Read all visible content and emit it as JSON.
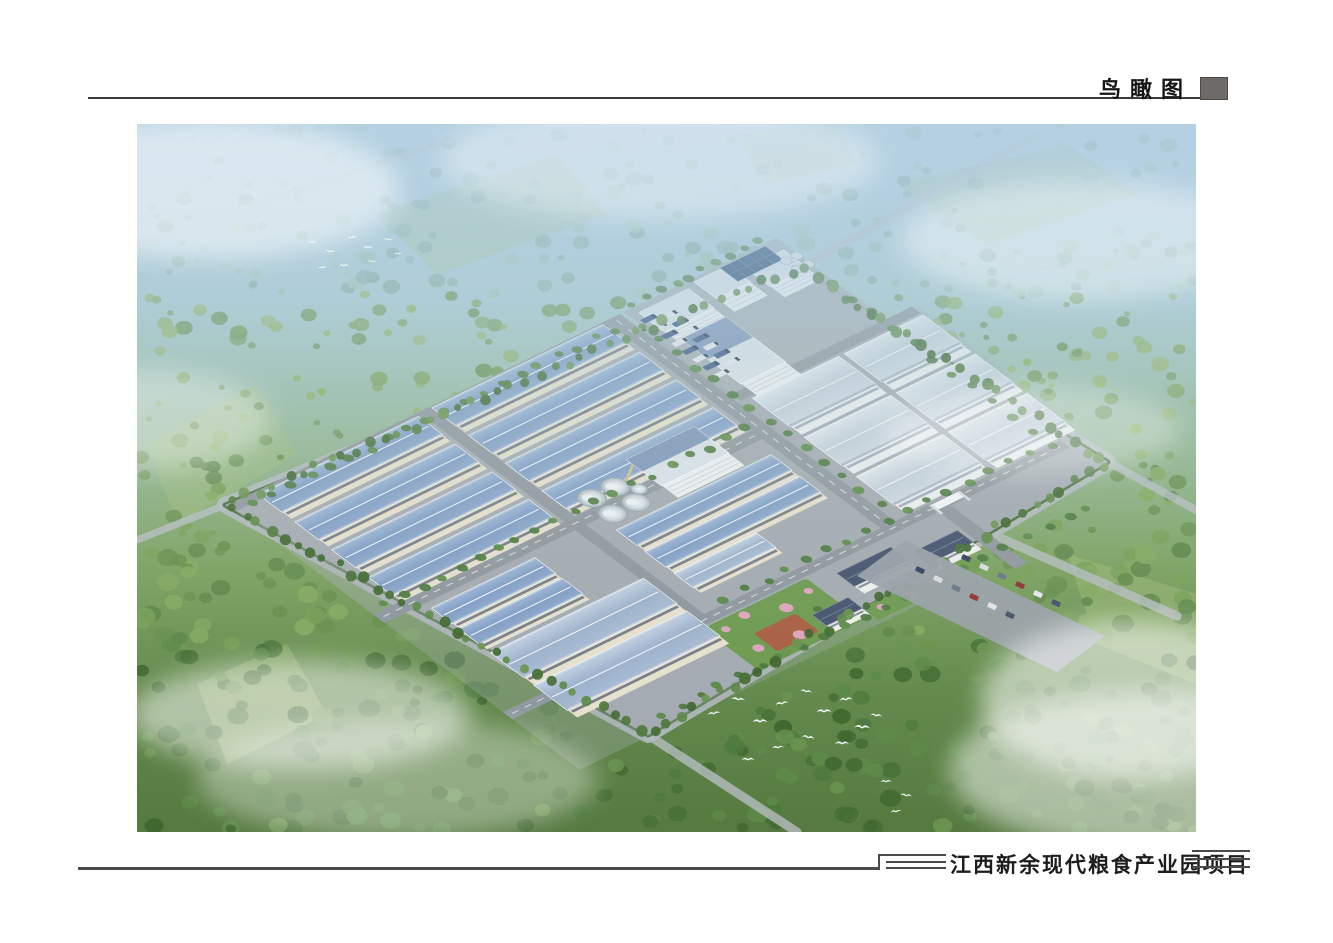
{
  "page": {
    "header": {
      "title": "鸟瞰图",
      "marker_icon": "title-block-square"
    },
    "footer": {
      "project_title": "江西新余现代粮食产业园项目",
      "deco_left_icon": "triple-rule-step",
      "deco_right_icon": "triple-rule"
    }
  },
  "palette": {
    "rule": "#3c3c3c",
    "marker": "#6e6a68",
    "plot": "#a3aab1",
    "road": "#90989f",
    "dash": "#eef1f4",
    "apron": "#a9afb6",
    "ring": "#b4bac0",
    "hedge": "#4a6e3c",
    "blue_roof": [
      "#9fb8d8",
      "#7f9cc6",
      "#8ea9cc"
    ],
    "bluelight_roof": [
      "#c3d2e4",
      "#9db2cd",
      "#aabdd5"
    ],
    "white_roof": [
      "#e2e9f0",
      "#c6d1dd",
      "#d3dce6"
    ],
    "wall_cream": "#e6e0cf",
    "band_dark": "#49566a",
    "wall_white": "#edeff1",
    "band_gray": "#8494a6",
    "tower_wall": "#eff1f4",
    "tower_roof": "#dde3e9",
    "mill_blue": "#7089b2",
    "office_roof": "#47556f",
    "office_wall": "#eef0ee",
    "solar": "#2f4e74",
    "solar_grid": "#52749c",
    "truck_a": "#3c5a88",
    "truck_b": "#e8ebee",
    "silo_stroke": "#97a2ac",
    "conveyor": "#cfc08a",
    "garden": "#6f9b52",
    "garden_tree": "#4e7a3e",
    "blossom": "#e2a6c2",
    "plaza": "#b05a42",
    "bird": "#fbfdfe",
    "bg_stops": [
      [
        0,
        "#b9d3e2"
      ],
      [
        0.25,
        "#a8c9cf"
      ],
      [
        0.45,
        "#93b694"
      ],
      [
        0.62,
        "#7da263"
      ],
      [
        0.8,
        "#648a4e"
      ],
      [
        1,
        "#55793f"
      ]
    ],
    "haze_stops": [
      [
        0,
        "rgba(180,208,226,0.85)"
      ],
      [
        0.18,
        "rgba(180,208,226,0.55)"
      ],
      [
        0.38,
        "rgba(186,212,214,0.28)"
      ],
      [
        0.6,
        "rgba(200,220,205,0.08)"
      ],
      [
        0.78,
        "rgba(200,220,205,0)"
      ]
    ],
    "field": "#a4bf7d",
    "tree_bands": [
      [
        170,
        [
          "#8fb3a4",
          "#9cc0ae",
          "#86ab9d",
          "#a5c6b4"
        ]
      ],
      [
        330,
        [
          "#7ea45f",
          "#8db264",
          "#729a57",
          "#97b46c",
          "#6b9253"
        ]
      ],
      [
        520,
        [
          "#688f4e",
          "#78a058",
          "#5f874a",
          "#83a961"
        ]
      ],
      [
        9999,
        [
          "#4e7a3e",
          "#5d8a49",
          "#456f36",
          "#6b9450",
          "#3f672f"
        ]
      ]
    ],
    "car_colors": [
      "#35435e",
      "#d8dce1",
      "#6b7688",
      "#913535",
      "#e4e6ea",
      "#46536a"
    ]
  },
  "scene": {
    "viewbox": [
      1059,
      708
    ],
    "skew": {
      "a": 0.899,
      "b": -0.438,
      "c": 0.799,
      "d": 0.602,
      "tx": 91,
      "ty": 381
    },
    "plot_polygon": [
      [
        88,
        381
      ],
      [
        660,
        144
      ],
      [
        971,
        338
      ],
      [
        511,
        611
      ]
    ],
    "fields": [
      [
        [
          10,
          320
        ],
        [
          120,
          260
        ],
        [
          160,
          330
        ],
        [
          40,
          400
        ]
      ],
      [
        [
          240,
          90
        ],
        [
          420,
          30
        ],
        [
          470,
          90
        ],
        [
          300,
          150
        ]
      ],
      [
        [
          760,
          60
        ],
        [
          930,
          20
        ],
        [
          1000,
          70
        ],
        [
          850,
          120
        ]
      ],
      [
        [
          930,
          430
        ],
        [
          1059,
          470
        ],
        [
          1059,
          560
        ],
        [
          960,
          520
        ]
      ],
      [
        [
          60,
          560
        ],
        [
          150,
          520
        ],
        [
          190,
          590
        ],
        [
          90,
          640
        ]
      ],
      [
        [
          600,
          10
        ],
        [
          700,
          0
        ],
        [
          720,
          40
        ],
        [
          630,
          60
        ]
      ]
    ],
    "outer_roads": [
      [
        [
          660,
          146
        ],
        [
          900,
          10
        ],
        8
      ],
      [
        [
          511,
          611
        ],
        [
          660,
          708
        ],
        9
      ],
      [
        [
          971,
          338
        ],
        [
          1059,
          386
        ],
        8
      ],
      [
        [
          88,
          381
        ],
        [
          0,
          416
        ],
        7
      ],
      [
        [
          802,
          387
        ],
        [
          1040,
          492
        ],
        9
      ],
      [
        [
          0,
          120
        ],
        [
          330,
          10
        ],
        5
      ]
    ],
    "aprons": [
      [
        0,
        0,
        436,
        182,
        0.4
      ],
      [
        440,
        0,
        170,
        135,
        0.9
      ],
      [
        440,
        140,
        205,
        216,
        0.35
      ],
      [
        0,
        196,
        420,
        244,
        0.3
      ]
    ],
    "roads_local": [
      [
        0,
        0,
        436,
        10,
        0
      ],
      [
        212,
        0,
        12,
        356,
        0
      ],
      [
        0,
        182,
        436,
        14,
        1
      ],
      [
        420,
        0,
        16,
        356,
        1
      ],
      [
        440,
        136,
        200,
        11,
        0
      ],
      [
        0,
        344,
        620,
        12,
        1
      ],
      [
        474,
        356,
        14,
        95,
        0
      ]
    ],
    "structures": [
      [
        225,
        2,
        190,
        30,
        11,
        "blue"
      ],
      [
        225,
        48,
        190,
        30,
        11,
        "blue"
      ],
      [
        225,
        94,
        190,
        30,
        11,
        "blue"
      ],
      [
        225,
        140,
        190,
        30,
        11,
        "blue"
      ],
      [
        30,
        4,
        178,
        30,
        11,
        "blue"
      ],
      [
        30,
        50,
        178,
        30,
        11,
        "blue"
      ],
      [
        30,
        96,
        178,
        30,
        11,
        "blue"
      ],
      [
        30,
        142,
        178,
        30,
        11,
        "blue"
      ],
      [
        45,
        204,
        115,
        26,
        9,
        "blue"
      ],
      [
        45,
        238,
        115,
        26,
        9,
        "blue"
      ],
      [
        45,
        278,
        170,
        42,
        12,
        "bluelight"
      ],
      [
        45,
        332,
        170,
        42,
        12,
        "bluelight"
      ],
      [
        240,
        216,
        172,
        26,
        10,
        "blue"
      ],
      [
        240,
        252,
        172,
        26,
        10,
        "blue"
      ],
      [
        240,
        288,
        92,
        24,
        9,
        "bluelight"
      ],
      [
        450,
        150,
        96,
        48,
        13,
        "white"
      ],
      [
        552,
        150,
        88,
        48,
        13,
        "white"
      ],
      [
        450,
        215,
        96,
        48,
        13,
        "white"
      ],
      [
        552,
        215,
        88,
        48,
        13,
        "white"
      ],
      [
        450,
        280,
        96,
        48,
        13,
        "white"
      ],
      [
        552,
        280,
        88,
        48,
        13,
        "white"
      ],
      [
        450,
        8,
        55,
        32,
        18,
        "tower"
      ],
      [
        515,
        4,
        38,
        28,
        22,
        "tower"
      ],
      [
        562,
        16,
        42,
        30,
        18,
        "tower"
      ],
      [
        455,
        55,
        50,
        75,
        20,
        "mill"
      ],
      [
        310,
        150,
        75,
        44,
        20,
        "mill"
      ],
      [
        350,
        368,
        60,
        22,
        12,
        "office"
      ],
      [
        420,
        384,
        50,
        20,
        11,
        "office"
      ],
      [
        296,
        398,
        40,
        18,
        10,
        "office"
      ],
      [
        475,
        345,
        30,
        9,
        8,
        "gate"
      ]
    ],
    "solar": [
      545,
      3,
      50,
      22
    ],
    "silos": {
      "big": [
        [
          252,
          172
        ],
        [
          278,
          172
        ],
        [
          252,
          198
        ],
        [
          278,
          198
        ]
      ],
      "bigR": 12,
      "extra": [
        292,
        186,
        7
      ],
      "small": [
        [
          596,
          28
        ],
        [
          608,
          28
        ],
        [
          596,
          42
        ],
        [
          608,
          42
        ]
      ],
      "smallR": 5
    },
    "conveyor": [
      [
        310,
        158
      ],
      [
        284,
        176
      ]
    ],
    "trucks": {
      "cols": [
        {
          "x": 444,
          "y0": 16,
          "n": 8
        },
        {
          "x": 462,
          "y0": 22,
          "n": 7
        }
      ],
      "step": 13,
      "w": 15,
      "h": 6
    },
    "gardens": [
      {
        "x": 210,
        "y": 358,
        "w": 115,
        "h": 70,
        "plaza": [
          240,
          388,
          46,
          30
        ],
        "blossoms": [
          [
            225,
            370
          ],
          [
            250,
            365
          ],
          [
            285,
            378
          ],
          [
            305,
            395
          ],
          [
            230,
            405
          ],
          [
            270,
            412
          ],
          [
            315,
            372
          ],
          [
            300,
            420
          ]
        ]
      },
      {
        "x": 336,
        "y": 416,
        "w": 120,
        "h": 20,
        "blossoms": [
          [
            350,
            424
          ],
          [
            380,
            427
          ],
          [
            410,
            423
          ],
          [
            440,
            426
          ]
        ]
      }
    ],
    "tree_rows": [
      [
        10,
        13,
        430,
        13,
        20
      ],
      [
        5,
        178,
        430,
        178,
        20
      ],
      [
        240,
        340,
        600,
        340,
        16
      ],
      [
        441,
        10,
        441,
        330,
        14
      ],
      [
        90,
        424,
        590,
        424,
        22
      ],
      [
        445,
        -5,
        605,
        -5,
        10
      ],
      [
        608,
        60,
        608,
        360,
        12
      ]
    ],
    "parking": {
      "poly": [
        [
          768,
          416
        ],
        [
          968,
          512
        ],
        [
          920,
          548
        ],
        [
          720,
          452
        ]
      ],
      "rows": [
        {
          "x": 780,
          "y": 442,
          "n": 6
        },
        {
          "x": 826,
          "y": 430,
          "n": 6
        }
      ],
      "dx": 18,
      "dy": 9
    },
    "mist": [
      [
        163,
        591,
        170,
        55,
        0.5
      ],
      [
        993,
        576,
        150,
        80,
        0.55
      ],
      [
        73,
        66,
        190,
        70,
        0.5
      ],
      [
        943,
        116,
        180,
        60,
        0.4
      ],
      [
        523,
        36,
        220,
        60,
        0.35
      ],
      [
        13,
        296,
        120,
        50,
        0.35
      ],
      [
        1013,
        646,
        200,
        80,
        0.5
      ],
      [
        893,
        306,
        150,
        45,
        0.3
      ],
      [
        260,
        655,
        200,
        60,
        0.35
      ]
    ],
    "birds": [
      [
        577,
        590,
        1.3,
        -8
      ],
      [
        601,
        576,
        1.4,
        6
      ],
      [
        623,
        598,
        1.5,
        0
      ],
      [
        645,
        580,
        1.3,
        -10
      ],
      [
        669,
        568,
        1.2,
        8
      ],
      [
        687,
        588,
        1.5,
        0
      ],
      [
        709,
        576,
        1.3,
        -6
      ],
      [
        725,
        604,
        1.6,
        4
      ],
      [
        705,
        620,
        1.4,
        0
      ],
      [
        671,
        614,
        1.3,
        10
      ],
      [
        641,
        624,
        1.2,
        -4
      ],
      [
        611,
        636,
        1.3,
        0
      ],
      [
        739,
        592,
        1.2,
        6
      ],
      [
        175,
        119,
        0.9,
        0
      ],
      [
        193,
        128,
        1,
        8
      ],
      [
        215,
        114,
        0.9,
        -8
      ],
      [
        231,
        124,
        1,
        0
      ],
      [
        251,
        116,
        0.9,
        6
      ],
      [
        207,
        142,
        1,
        0
      ],
      [
        185,
        144,
        0.9,
        -5
      ],
      [
        235,
        138,
        0.9,
        5
      ],
      [
        261,
        130,
        0.8,
        0
      ],
      [
        749,
        658,
        1.1,
        0
      ],
      [
        769,
        672,
        1.2,
        8
      ],
      [
        759,
        688,
        1.1,
        -6
      ]
    ],
    "trees": {
      "count": 1150,
      "seed": 42
    }
  }
}
